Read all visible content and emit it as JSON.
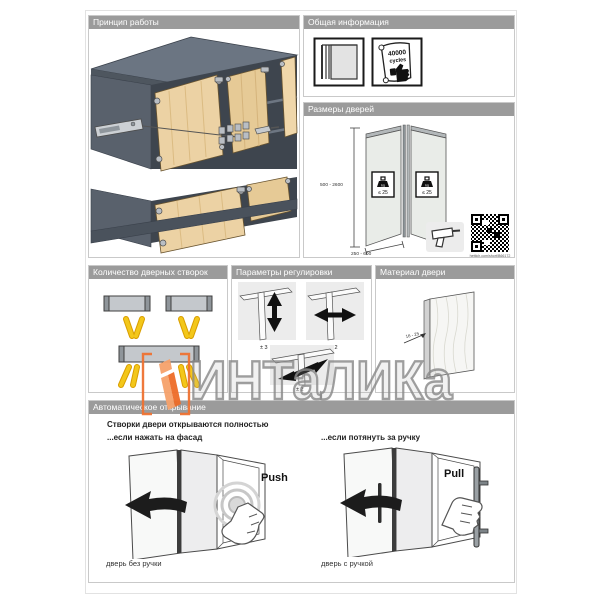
{
  "watermark": {
    "text": "ИНТаЛИКа"
  },
  "panels": {
    "principle": {
      "title": "Принцип работы"
    },
    "general_info": {
      "title": "Общая информация",
      "cycles_value": "40000",
      "cycles_unit": "cycles"
    },
    "door_sizes": {
      "title": "Размеры дверей",
      "height_range": "500 - 2600",
      "width_range": "250 - 600",
      "weight_unit": "kg",
      "weight_limit": "≤ 25",
      "link": "hettich.com/short/B66172"
    },
    "leaf_count": {
      "title": "Количество дверных створок"
    },
    "adjustment": {
      "title": "Параметры регулировки",
      "vertical": "± 3",
      "horizontal": "± 2",
      "depth": "± 2"
    },
    "door_material": {
      "title": "Материал двери",
      "thickness_range": "16 - 25"
    },
    "auto_opening": {
      "title": "Автоматическое открывание",
      "headline": "Створки двери открываются полностью",
      "push_condition": "...если нажать на фасад",
      "pull_condition": "...если потянуть за ручку",
      "push_label": "Push",
      "pull_label": "Pull",
      "push_caption": "дверь без ручки",
      "pull_caption": "дверь с ручкой"
    }
  },
  "colors": {
    "header_bar": "#9b9b9b",
    "door_wood": "#ecd2a4",
    "cabinet_dark": "#4a525c",
    "accent_yellow": "#f3c71a",
    "brand_orange": "#ee6c28"
  }
}
